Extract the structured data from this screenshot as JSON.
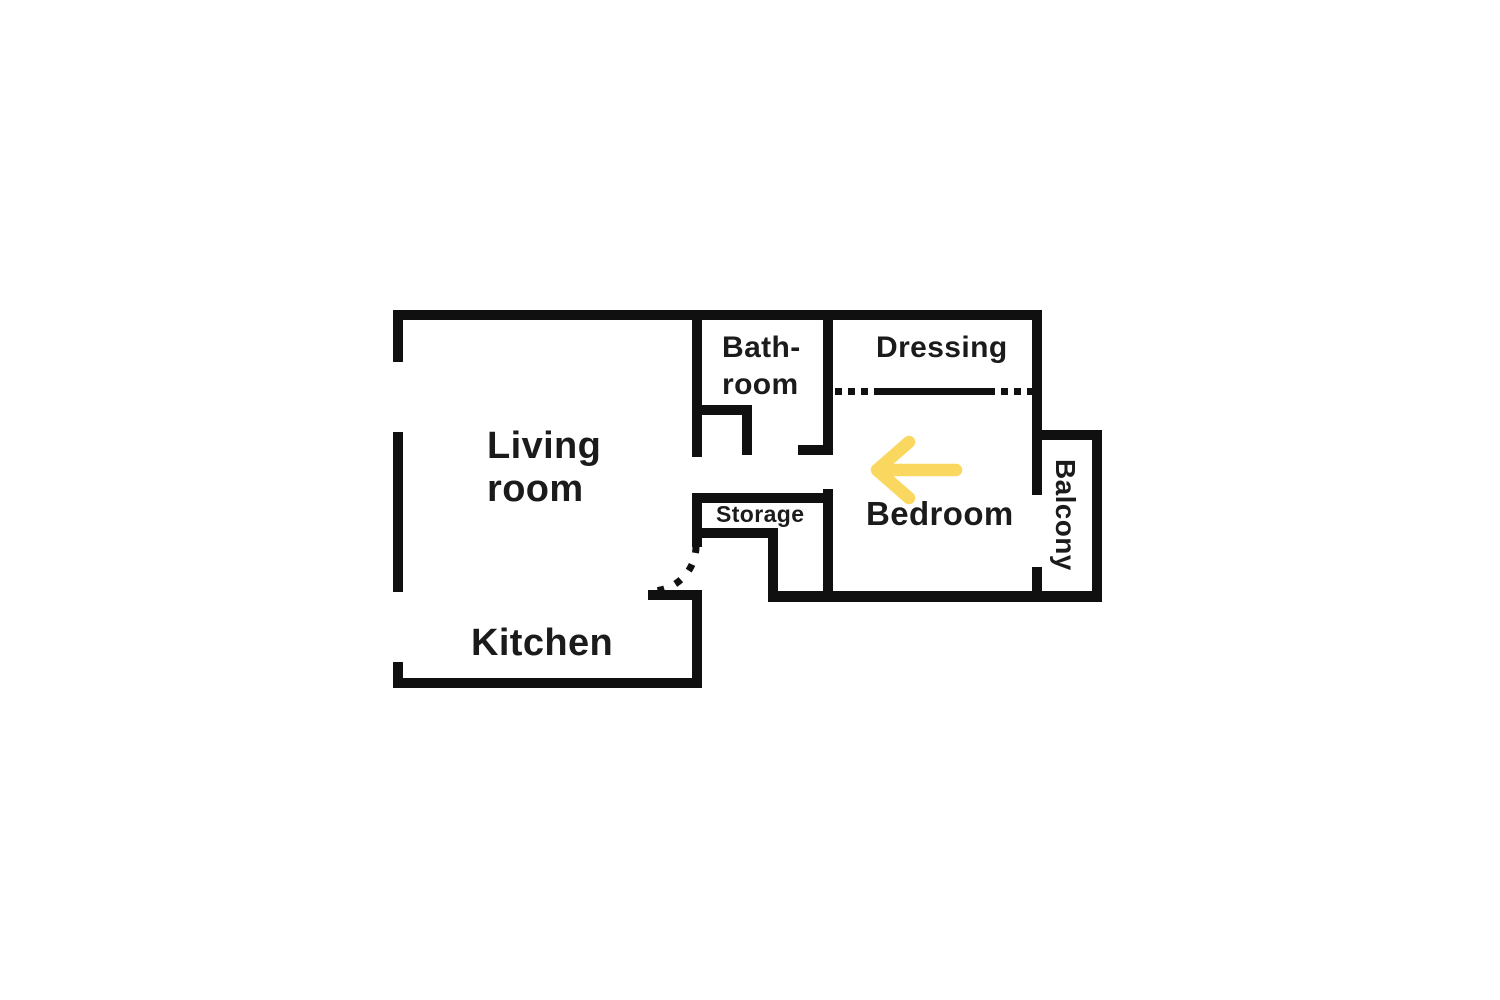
{
  "diagram": {
    "type": "apartment-floor-plan",
    "background_color": "#ffffff",
    "wall_color": "#101010",
    "text_color": "#1b1b1b",
    "arrow_color": "#FAD75F"
  },
  "labels": {
    "living_room": {
      "line1": "Living",
      "line2": "room"
    },
    "kitchen": "Kitchen",
    "bathroom": {
      "line1": "Bath-",
      "line2": "room"
    },
    "dressing": "Dressing",
    "storage": "Storage",
    "bedroom": "Bedroom",
    "balcony": "Balcony"
  },
  "walls": [
    {
      "name": "exterior-wall-top",
      "x": 393,
      "y": 310,
      "w": 649,
      "h": 10
    },
    {
      "name": "exterior-wall-left-upper",
      "x": 393,
      "y": 310,
      "w": 10,
      "h": 52
    },
    {
      "name": "exterior-wall-left-middle",
      "x": 393,
      "y": 432,
      "w": 10,
      "h": 160
    },
    {
      "name": "exterior-wall-left-lower",
      "x": 393,
      "y": 662,
      "w": 10,
      "h": 26
    },
    {
      "name": "exterior-wall-bottom-kitchen",
      "x": 393,
      "y": 678,
      "w": 309,
      "h": 10
    },
    {
      "name": "kitchen-east-wall",
      "x": 692,
      "y": 592,
      "w": 10,
      "h": 96
    },
    {
      "name": "kitchen-door-stub",
      "x": 648,
      "y": 590,
      "w": 54,
      "h": 10
    },
    {
      "name": "living-room-east-wall",
      "x": 692,
      "y": 310,
      "w": 10,
      "h": 147
    },
    {
      "name": "bathroom-partition-horizontal",
      "x": 692,
      "y": 405,
      "w": 60,
      "h": 10
    },
    {
      "name": "bathroom-partition-vertical",
      "x": 742,
      "y": 405,
      "w": 10,
      "h": 50
    },
    {
      "name": "bathroom-dressing-wall",
      "x": 823,
      "y": 310,
      "w": 10,
      "h": 145
    },
    {
      "name": "bathroom-door-stub",
      "x": 798,
      "y": 445,
      "w": 35,
      "h": 10
    },
    {
      "name": "storage-top-wall",
      "x": 692,
      "y": 493,
      "w": 141,
      "h": 10
    },
    {
      "name": "storage-west-wall",
      "x": 692,
      "y": 493,
      "w": 10,
      "h": 54
    },
    {
      "name": "storage-bottom-wall",
      "x": 692,
      "y": 528,
      "w": 86,
      "h": 10
    },
    {
      "name": "storage-bedroom-connector",
      "x": 768,
      "y": 528,
      "w": 10,
      "h": 74
    },
    {
      "name": "bedroom-west-wall",
      "x": 823,
      "y": 489,
      "w": 10,
      "h": 113
    },
    {
      "name": "bottom-wall-bedroom-balcony",
      "x": 768,
      "y": 591,
      "w": 334,
      "h": 11
    },
    {
      "name": "exterior-wall-right-upper",
      "x": 1032,
      "y": 310,
      "w": 10,
      "h": 185
    },
    {
      "name": "exterior-wall-right-stub",
      "x": 1032,
      "y": 567,
      "w": 10,
      "h": 35
    },
    {
      "name": "balcony-top-wall",
      "x": 1042,
      "y": 430,
      "w": 60,
      "h": 10
    },
    {
      "name": "balcony-right-wall",
      "x": 1092,
      "y": 430,
      "w": 10,
      "h": 172
    }
  ],
  "partitions": [
    {
      "name": "dressing-divider-dotted-left",
      "style": "dotted",
      "x": 835,
      "y": 388,
      "w": 39,
      "h": 7
    },
    {
      "name": "dressing-divider-solid",
      "style": "solid",
      "x": 874,
      "y": 388,
      "w": 114,
      "h": 7
    },
    {
      "name": "dressing-divider-dotted-right",
      "style": "dotted",
      "x": 988,
      "y": 388,
      "w": 44,
      "h": 7
    }
  ],
  "door_swing_arc": {
    "path": "M 696 546 A 45 45 0 0 1 651 591"
  },
  "arrow": {
    "path": "M 956 470 L 881 470 M 909 442 L 877 470 L 909 498",
    "direction": "left"
  }
}
